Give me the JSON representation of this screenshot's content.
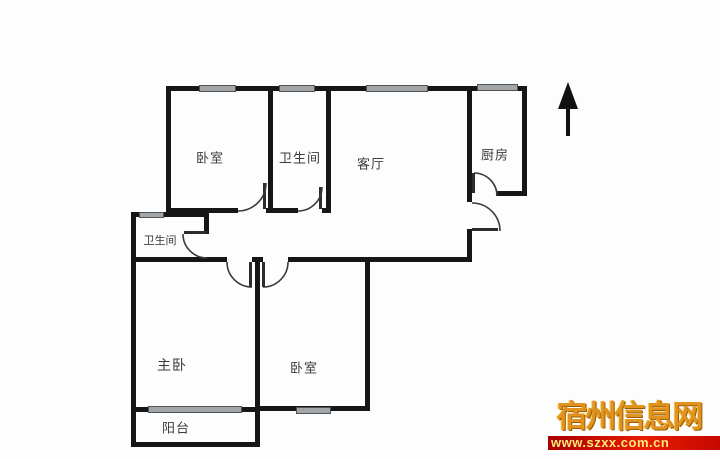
{
  "floor_plan": {
    "rooms": [
      {
        "id": "bedroom-top",
        "label": "卧室"
      },
      {
        "id": "bathroom-top",
        "label": "卫生间"
      },
      {
        "id": "living-room",
        "label": "客厅"
      },
      {
        "id": "kitchen",
        "label": "厨房"
      },
      {
        "id": "bathroom-small",
        "label": "卫生间"
      },
      {
        "id": "master-bedroom",
        "label": "主卧"
      },
      {
        "id": "bedroom-bottom",
        "label": "卧室"
      },
      {
        "id": "balcony",
        "label": "阳台"
      }
    ],
    "north_indicator": "north-arrow-up"
  },
  "watermark": {
    "site_name": "宿州信息网",
    "site_url": "www.szxx.com.cn",
    "name_color": "#e2921e",
    "bar_color": "#d81000",
    "url_color": "#ffe87a"
  },
  "colors": {
    "wall": "#161616",
    "window_fill": "#a3a6a8",
    "door_arc": "#3a3a3a",
    "label": "#3b3b3b",
    "background": "#fdfdfd"
  }
}
